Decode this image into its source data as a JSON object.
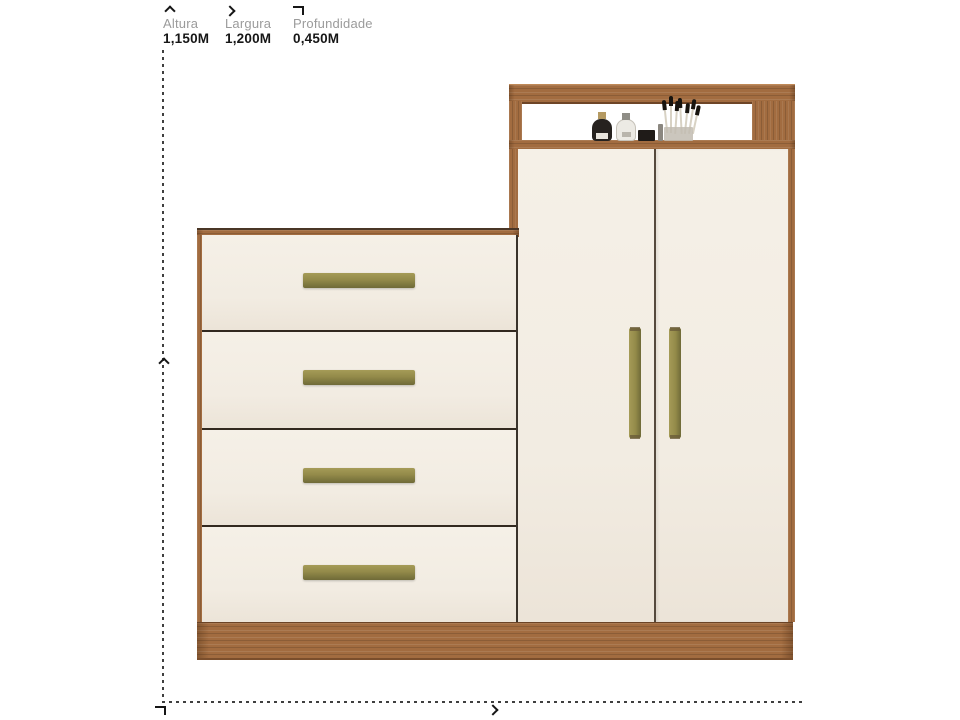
{
  "legend": {
    "items": [
      {
        "icon": "height-arrow-icon",
        "label": "Altura",
        "value": "1,150M"
      },
      {
        "icon": "width-arrow-icon",
        "label": "Largura",
        "value": "1,200M"
      },
      {
        "icon": "depth-arrow-icon",
        "label": "Profundidade",
        "value": "0,450M"
      }
    ]
  },
  "guides": {
    "height_guide": "vertical-dashed-line",
    "width_guide": "horizontal-dashed-line",
    "height_marker": "up-chevron",
    "width_marker": "right-chevron",
    "depth_marker": "corner-glyph"
  },
  "product": {
    "kind": "multiuse-dresser-wardrobe",
    "drawer_count": 4,
    "door_count": 2,
    "shelf_items": [
      "black-perfume-bottle",
      "white-perfume-bottle",
      "black-cosmetic-case",
      "lipstick",
      "makeup-brush-set"
    ]
  },
  "theme": {
    "wood": "#a26c40",
    "wood_dark": "#7c4e2b",
    "front": "#f2ece2",
    "front_light": "#f5f0e7",
    "front_dark": "#ece4d8",
    "handle": "#938a49",
    "handle_light": "#a59b57",
    "handle_dark": "#6f6a38",
    "seam": "#55493d",
    "seam_dark": "#32291f",
    "guide": "#3f3f3f",
    "label_gray": "#9b9b9b",
    "value_black": "#161616",
    "gold": "#b59a62"
  }
}
